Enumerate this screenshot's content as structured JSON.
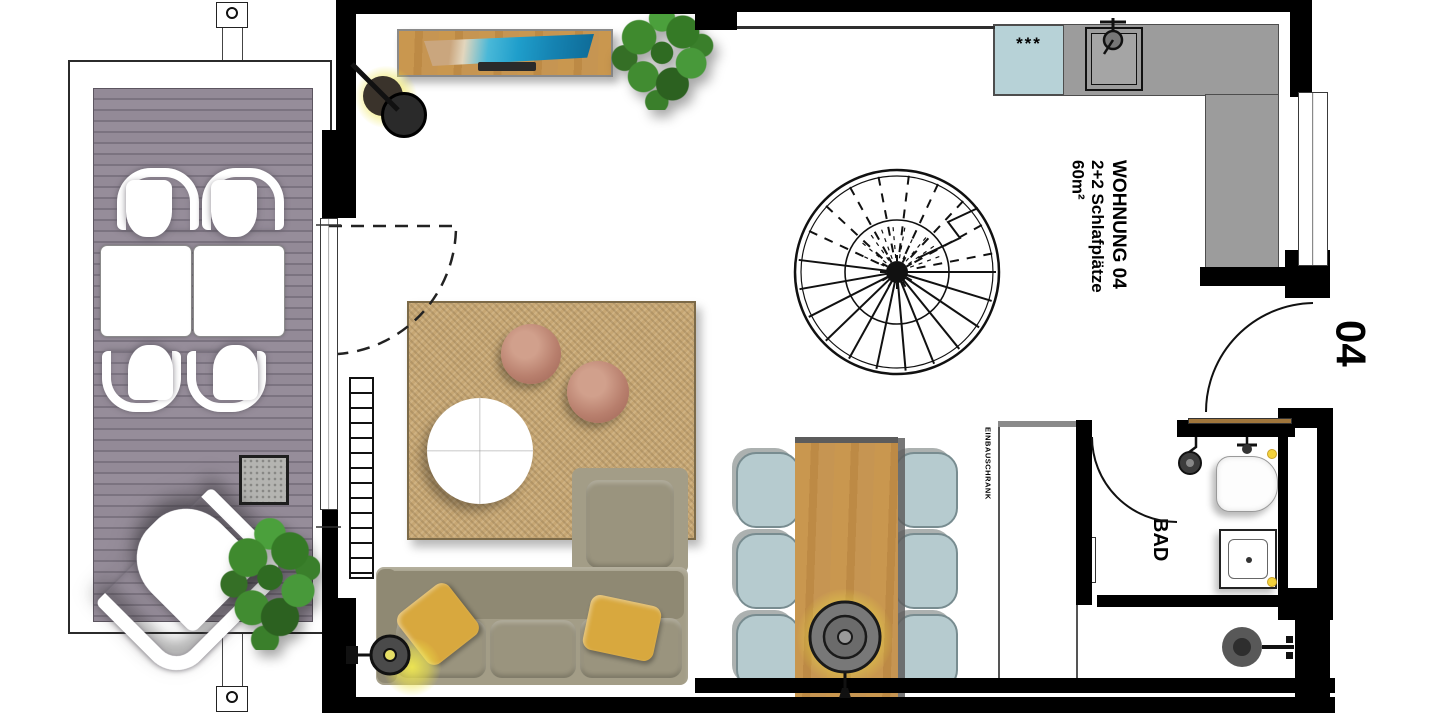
{
  "plan": {
    "unit": {
      "title": "WOHNUNG 04",
      "subtitle": "2+2 Schlafplätze",
      "area": "60m²",
      "number": "04"
    },
    "labels": {
      "bathroom": "BAD",
      "wardrobe": "EINBAUSCHRANK",
      "cooktop": "***"
    },
    "colors": {
      "wall": "#000000",
      "terrace_deck": "#8c8390",
      "rug": "#c6a673",
      "wood": "#c4924e",
      "sofa": "#a39d87",
      "dining_chair": "#b6cbcf",
      "cooktop": "#b7d2d7",
      "kitchen_counter": "#9c9c9c",
      "pouf": "#b87f6d",
      "pillow": "#d8a83e",
      "lamp_glow": "#ece04f",
      "plant": "#3a7c28"
    },
    "fixtures": [
      "spiral-staircase",
      "kitchen-counter",
      "cooktop",
      "kitchen-sink",
      "dining-table",
      "dining-chair",
      "sofa",
      "rug",
      "coffee-table",
      "pouf",
      "sideboard",
      "tv",
      "radiator",
      "built-in-wardrobe",
      "toilet",
      "bathroom-sink",
      "shower-head",
      "pendant-light",
      "wall-light",
      "floor-lamp",
      "plant",
      "terrace-table",
      "terrace-chair",
      "lounge-chair",
      "concrete-cube",
      "door-swing",
      "window",
      "balcony-post"
    ]
  }
}
